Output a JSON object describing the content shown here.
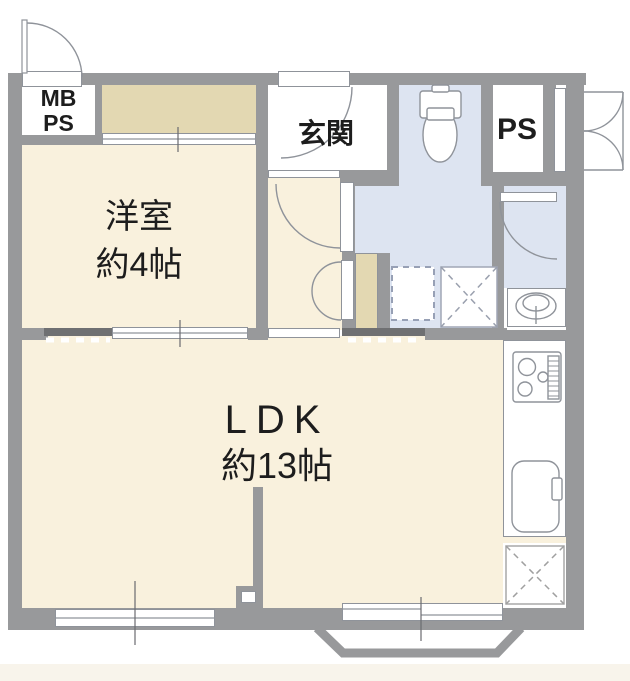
{
  "rooms": {
    "western_room": {
      "name": "洋室",
      "size": "約4帖"
    },
    "ldk": {
      "name": "LDK",
      "size": "約13帖"
    },
    "entrance": {
      "name": "玄関"
    },
    "meter_box_pipe_space": {
      "line1": "MB",
      "line2": "PS"
    },
    "pipe_space": {
      "label": "PS"
    }
  },
  "fixtures": {
    "toilet": "toilet",
    "washbasin": "washbasin",
    "stove": "gas-stove",
    "sink": "kitchen-sink",
    "washing_machine_pan": "washing-machine-pan",
    "appliance_space": "appliance-space",
    "bay_window": "bay-window"
  },
  "colors": {
    "wall": "#98999b",
    "floor_cream": "#f9f1dd",
    "closet_tan": "#e3d8b2",
    "wet_area_blue": "#dde4f1",
    "door_rail_dark": "#6f7072",
    "outline": "#8f939a"
  }
}
